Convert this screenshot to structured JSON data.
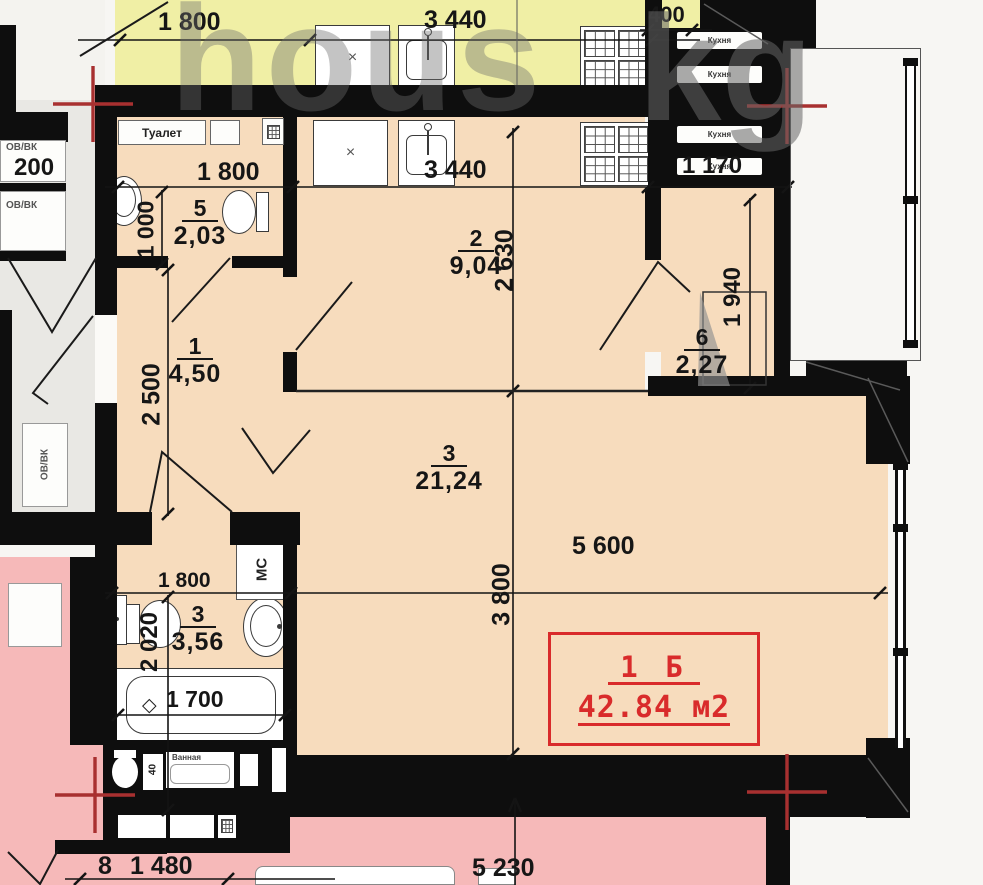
{
  "apartment": {
    "type_label": "1 Б",
    "area_label": "42.84 м2"
  },
  "rooms": {
    "hall": {
      "num": "1",
      "area": "4,50"
    },
    "kitchen": {
      "num": "2",
      "area": "9,04"
    },
    "living": {
      "num": "3",
      "area": "21,24"
    },
    "bathroom": {
      "num": "3",
      "area": "3,56"
    },
    "wc": {
      "num": "5",
      "area": "2,03"
    },
    "pantry": {
      "num": "6",
      "area": "2,27"
    }
  },
  "dimensions": {
    "top_1800": "1 800",
    "top_3440": "3 440",
    "top_400": "400",
    "vent_1170": "1 170",
    "kitchen_3440": "3 440",
    "wc_1800": "1 800",
    "wc_1000": "1 000",
    "hall_2500": "2 500",
    "kitchen_2630": "2 630",
    "pantry_1940": "1 940",
    "living_5600": "5 600",
    "living_3800": "3 800",
    "bath_1800": "1 800",
    "bath_2020": "2 020",
    "tub_1700": "1 700",
    "bottom_8": "8",
    "bottom_1480": "1 480",
    "bottom_5230": "5 230",
    "left_200": "200",
    "below_40": "40"
  },
  "annotations": {
    "toilet_top": "Туалет",
    "ovvk": "ОВ/ВК",
    "ms": "МС",
    "vent_kitchen": "Кухня",
    "bath_below": "Ванная",
    "x_mark": "×",
    "diamond": "◇"
  },
  "watermark": {
    "p1": "hous",
    "p2": "kg"
  },
  "colors": {
    "wall": "#0e0e0e",
    "room_peach": "#f7dcbd",
    "room_yellow": "#f0efa5",
    "room_pink": "#f6b9b9",
    "axis_red": "#a83030",
    "label_red": "#d92b2b"
  }
}
